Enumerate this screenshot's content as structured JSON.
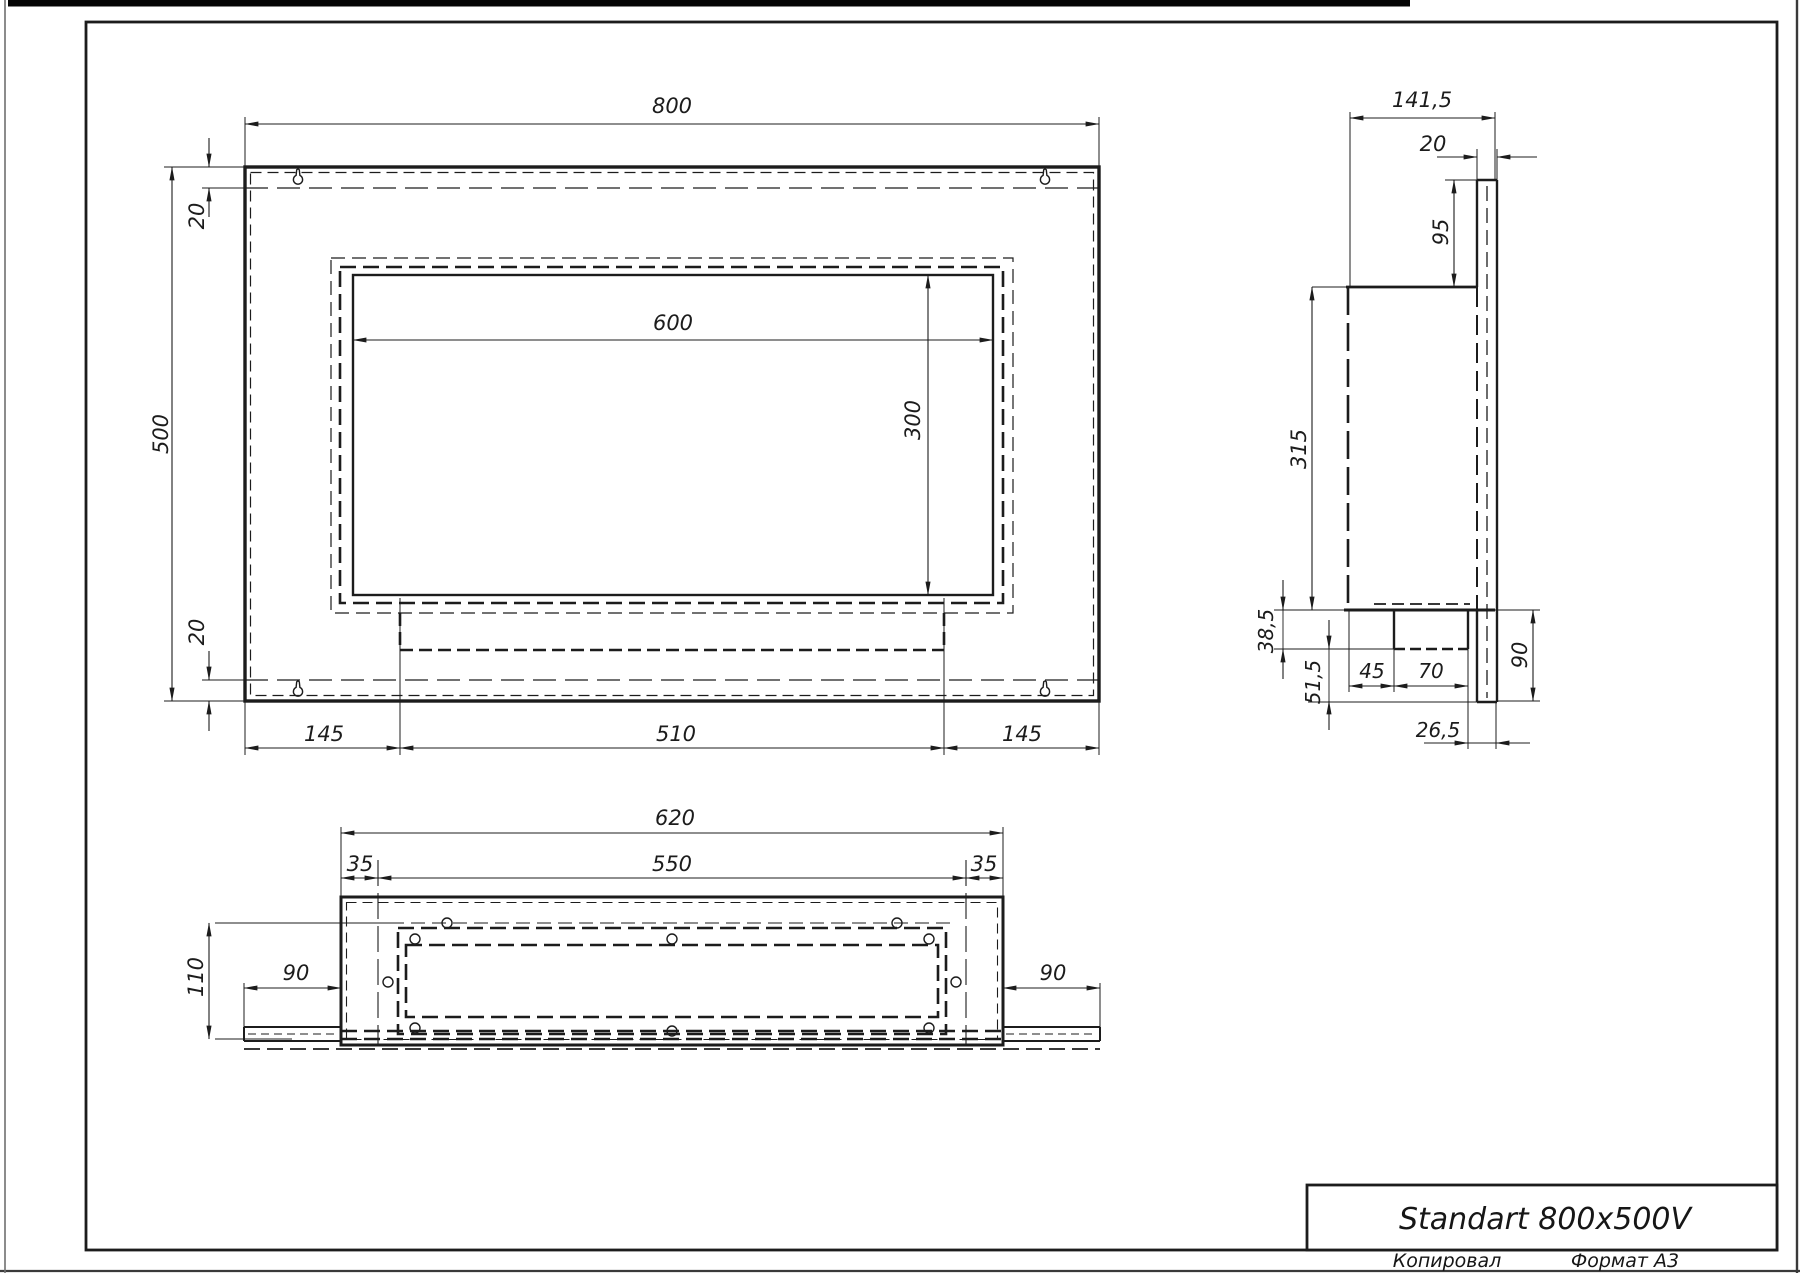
{
  "sheet": {
    "title": "Standart 800x500V",
    "footer_left": "Копировал",
    "footer_right": "Формат А3",
    "ink_color": "#1c1c1c",
    "paper_color": "#ffffff"
  },
  "front_view": {
    "dims": {
      "width": "800",
      "height": "500",
      "flange_top": "20",
      "flange_bottom": "20",
      "opening_width": "600",
      "opening_height": "300",
      "foot_left": "145",
      "tray_width": "510",
      "foot_right": "145"
    }
  },
  "side_view": {
    "dims": {
      "depth": "141,5",
      "wall_plate_thickness": "20",
      "plate_above_body": "95",
      "body_height": "315",
      "tray_depth": "38,5",
      "below_tray": "51,5",
      "tray_setback": "45",
      "tray_width": "70",
      "plate_below_body": "90",
      "tray_to_plate": "26,5"
    }
  },
  "bottom_view": {
    "dims": {
      "box_width": "620",
      "opening_width": "550",
      "inset_left": "35",
      "inset_right": "35",
      "depth": "110",
      "wing_left": "90",
      "wing_right": "90"
    }
  }
}
